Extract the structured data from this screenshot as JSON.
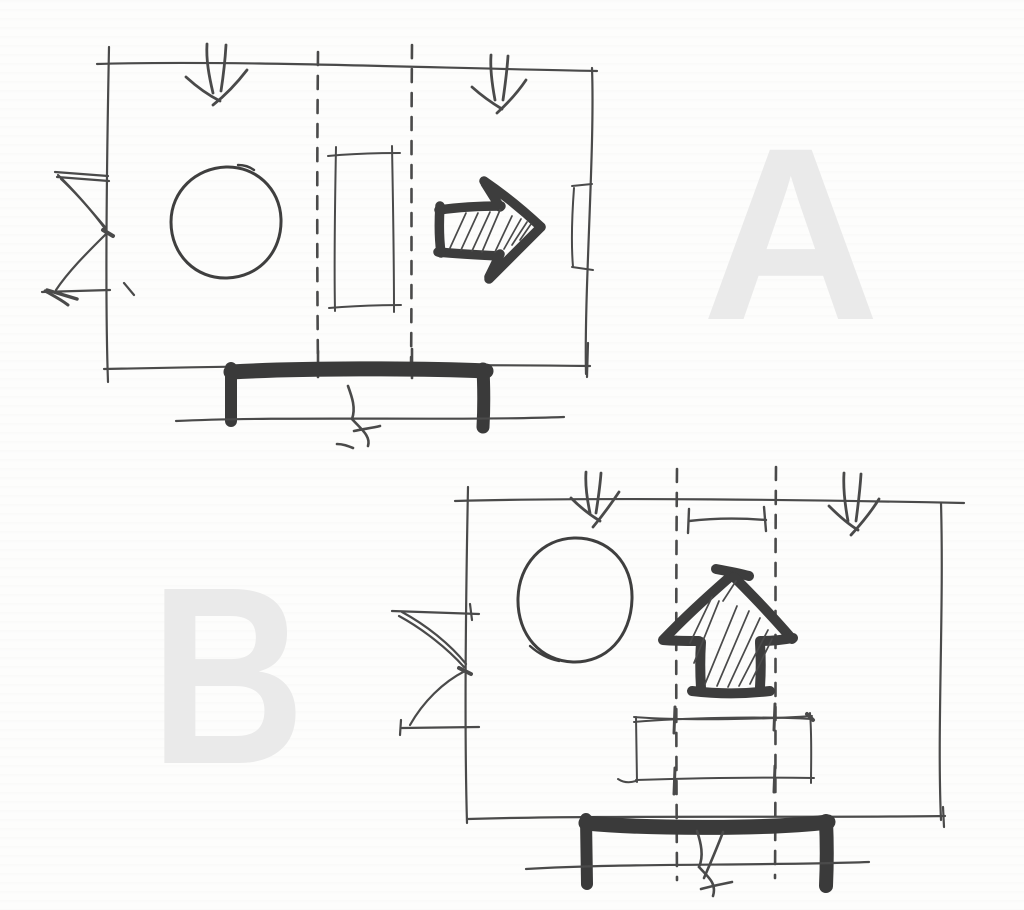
{
  "watermarks": {
    "option_a": "A",
    "option_b": "B"
  },
  "colors": {
    "paper": "#fdfdfc",
    "ink_thin": "#4a4a4a",
    "ink_marker_bold": "#3d3d3d",
    "hatch": "#4e4e4e",
    "watermark_gray": "#eaeaea"
  }
}
